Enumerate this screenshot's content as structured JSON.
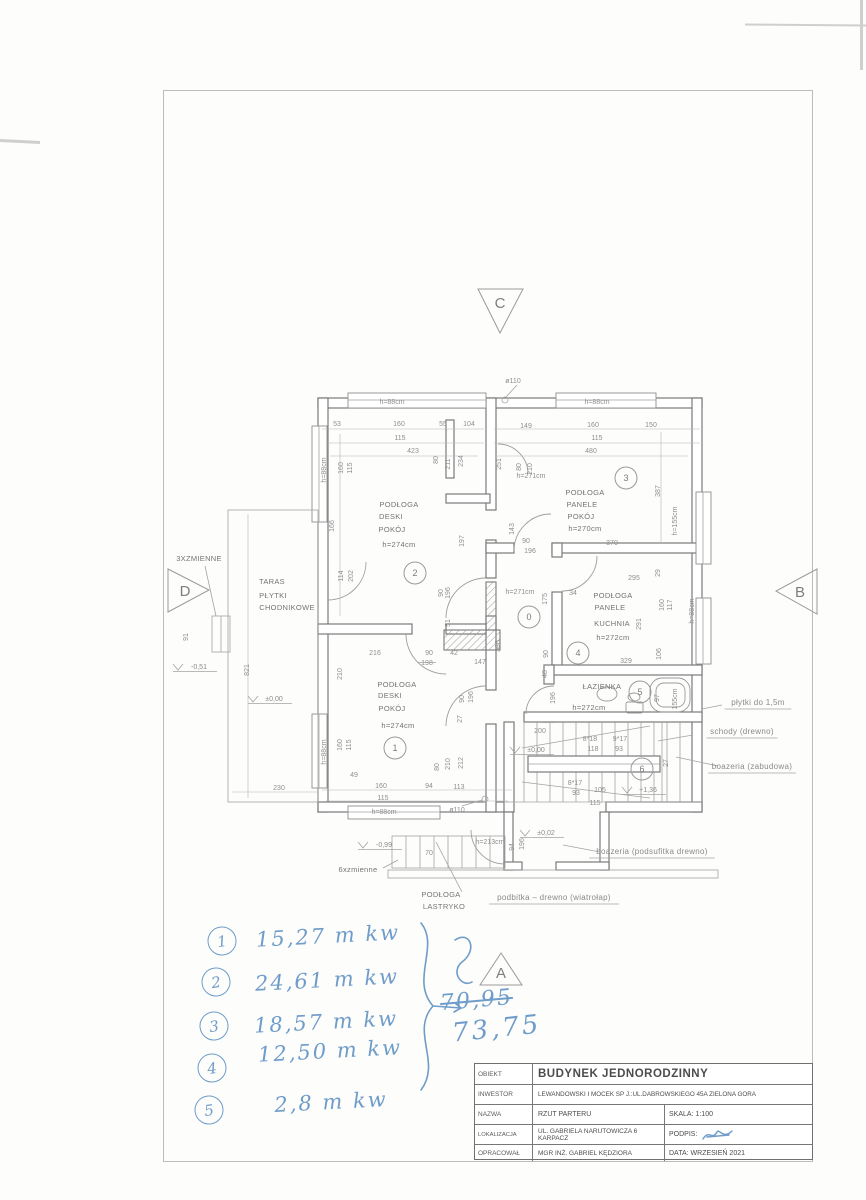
{
  "title_block": {
    "rows": [
      {
        "label": "OBIEKT",
        "value": "BUDYNEK JEDNORODZINNY"
      },
      {
        "label": "INWESTOR",
        "value": "LEWANDOWSKI I MOCEK SP J.:UL.DABROWSKIEGO 45A ZIELONA GORA"
      },
      {
        "label": "NAZWA",
        "value": "RZUT PARTERU",
        "right_label": "SKALA:",
        "right_value": "1:100"
      },
      {
        "label": "LOKALIZACJA",
        "value": "UL. GABRIELA NARUTOWICZA 6 KARPACZ",
        "right_label": "PODPIS:",
        "right_value": ""
      },
      {
        "label": "OPRACOWAŁ",
        "value": "MGR INŻ. GABRIEL KĘDZIORA",
        "right_label": "DATA:",
        "right_value": "WRZESIEŃ 2021"
      }
    ]
  },
  "handwritten": {
    "items": [
      {
        "n": "1",
        "t": "15,27 m kw",
        "cx": 222,
        "cy": 941,
        "tx": 328,
        "ty": 936
      },
      {
        "n": "2",
        "t": "24,61 m kw",
        "cx": 216,
        "cy": 982,
        "tx": 327,
        "ty": 980
      },
      {
        "n": "3",
        "t": "18,57 m kw",
        "cx": 214,
        "cy": 1026,
        "tx": 326,
        "ty": 1022
      },
      {
        "n": "4",
        "t": "12,50 m kw",
        "cx": 212,
        "cy": 1068,
        "tx": 330,
        "ty": 1051
      },
      {
        "n": "5",
        "t": "2,8  m kw",
        "cx": 209,
        "cy": 1110,
        "tx": 331,
        "ty": 1102
      }
    ],
    "sum_old": "70,95",
    "sum_new": "73,75"
  },
  "markers": {
    "a": "A",
    "b": "B",
    "c": "C",
    "d": "D"
  },
  "plan": {
    "rooms": [
      {
        "n": "2",
        "x": 415,
        "y": 573
      },
      {
        "n": "3",
        "x": 626,
        "y": 478
      },
      {
        "n": "0",
        "x": 529,
        "y": 617
      },
      {
        "n": "4",
        "x": 578,
        "y": 653
      },
      {
        "n": "5",
        "x": 640,
        "y": 692
      },
      {
        "n": "6",
        "x": 642,
        "y": 769
      },
      {
        "n": "1",
        "x": 395,
        "y": 748
      }
    ],
    "labels": [
      {
        "t": "ø110",
        "x": 513,
        "y": 383
      },
      {
        "t": "h=88cm",
        "x": 392,
        "y": 404
      },
      {
        "t": "h=88cm",
        "x": 597,
        "y": 404
      },
      {
        "t": "53",
        "x": 337,
        "y": 426
      },
      {
        "t": "160",
        "x": 399,
        "y": 426
      },
      {
        "t": "55",
        "x": 443,
        "y": 426
      },
      {
        "t": "104",
        "x": 469,
        "y": 426
      },
      {
        "t": "115",
        "x": 400,
        "y": 440
      },
      {
        "t": "423",
        "x": 413,
        "y": 453
      },
      {
        "t": "80",
        "x": 438,
        "y": 460,
        "v": 1
      },
      {
        "t": "211",
        "x": 450,
        "y": 464,
        "v": 1
      },
      {
        "t": "234",
        "x": 463,
        "y": 461,
        "v": 1
      },
      {
        "t": "149",
        "x": 526,
        "y": 428
      },
      {
        "t": "160",
        "x": 593,
        "y": 427
      },
      {
        "t": "150",
        "x": 651,
        "y": 427
      },
      {
        "t": "115",
        "x": 597,
        "y": 440
      },
      {
        "t": "480",
        "x": 591,
        "y": 453
      },
      {
        "t": "251",
        "x": 501,
        "y": 464,
        "v": 1
      },
      {
        "t": "80",
        "x": 521,
        "y": 467,
        "v": 1
      },
      {
        "t": "210",
        "x": 532,
        "y": 469,
        "v": 1
      },
      {
        "t": "h=271cm",
        "x": 531,
        "y": 478
      },
      {
        "t": "387",
        "x": 660,
        "y": 491,
        "v": 1
      },
      {
        "t": "h=155cm",
        "x": 677,
        "y": 521,
        "v": 1
      },
      {
        "t": "PODŁOGA",
        "x": 585,
        "y": 495,
        "c": "lbl"
      },
      {
        "t": "PANELE",
        "x": 582,
        "y": 507,
        "c": "lbl"
      },
      {
        "t": "POKÓJ",
        "x": 581,
        "y": 519,
        "c": "lbl"
      },
      {
        "t": "h=270cm",
        "x": 585,
        "y": 531,
        "c": "lbl"
      },
      {
        "t": "143",
        "x": 514,
        "y": 529,
        "v": 1
      },
      {
        "t": "90",
        "x": 526,
        "y": 543
      },
      {
        "t": "196",
        "x": 530,
        "y": 553
      },
      {
        "t": "370",
        "x": 612,
        "y": 545
      },
      {
        "t": "h=88cm",
        "x": 326,
        "y": 470,
        "v": 1
      },
      {
        "t": "160",
        "x": 343,
        "y": 468,
        "v": 1
      },
      {
        "t": "115",
        "x": 352,
        "y": 468,
        "v": 1
      },
      {
        "t": "166",
        "x": 334,
        "y": 526,
        "v": 1
      },
      {
        "t": "197",
        "x": 464,
        "y": 541,
        "v": 1
      },
      {
        "t": "114",
        "x": 343,
        "y": 576,
        "v": 1
      },
      {
        "t": "202",
        "x": 353,
        "y": 576,
        "v": 1
      },
      {
        "t": "PODŁOGA",
        "x": 399,
        "y": 507,
        "c": "lbl"
      },
      {
        "t": "DESKI",
        "x": 391,
        "y": 519,
        "c": "lbl"
      },
      {
        "t": "POKÓJ",
        "x": 392,
        "y": 532,
        "c": "lbl"
      },
      {
        "t": "h=274cm",
        "x": 399,
        "y": 547,
        "c": "lbl"
      },
      {
        "t": "h=271cm",
        "x": 520,
        "y": 594
      },
      {
        "t": "90",
        "x": 443,
        "y": 593,
        "v": 1
      },
      {
        "t": "196",
        "x": 450,
        "y": 593,
        "v": 1
      },
      {
        "t": "51",
        "x": 450,
        "y": 623,
        "v": 1
      },
      {
        "t": "175",
        "x": 547,
        "y": 599,
        "v": 1
      },
      {
        "t": "396",
        "x": 500,
        "y": 646,
        "v": 1
      },
      {
        "t": "147",
        "x": 480,
        "y": 664
      },
      {
        "t": "90",
        "x": 548,
        "y": 654,
        "v": 1
      },
      {
        "t": "48",
        "x": 547,
        "y": 674,
        "v": 1
      },
      {
        "t": "295",
        "x": 634,
        "y": 580
      },
      {
        "t": "29",
        "x": 660,
        "y": 573,
        "v": 1
      },
      {
        "t": "34",
        "x": 573,
        "y": 595
      },
      {
        "t": "PODŁOGA",
        "x": 613,
        "y": 598,
        "c": "lbl"
      },
      {
        "t": "PANELE",
        "x": 610,
        "y": 610,
        "c": "lbl"
      },
      {
        "t": "KUCHNIA",
        "x": 612,
        "y": 626,
        "c": "lbl"
      },
      {
        "t": "h=272cm",
        "x": 613,
        "y": 640,
        "c": "lbl"
      },
      {
        "t": "291",
        "x": 641,
        "y": 624,
        "v": 1
      },
      {
        "t": "160",
        "x": 664,
        "y": 605,
        "v": 1
      },
      {
        "t": "117",
        "x": 672,
        "y": 605,
        "v": 1
      },
      {
        "t": "h=88cm",
        "x": 694,
        "y": 611,
        "v": 1
      },
      {
        "t": "106",
        "x": 661,
        "y": 654,
        "v": 1
      },
      {
        "t": "329",
        "x": 626,
        "y": 663
      },
      {
        "t": "ŁAZIENKA",
        "x": 602,
        "y": 689,
        "c": "lbl"
      },
      {
        "t": "h=272cm",
        "x": 589,
        "y": 710,
        "c": "lbl"
      },
      {
        "t": "97",
        "x": 659,
        "y": 698,
        "v": 1
      },
      {
        "t": "155cm",
        "x": 677,
        "y": 699,
        "v": 1
      },
      {
        "t": "196",
        "x": 555,
        "y": 698,
        "v": 1
      },
      {
        "t": "200",
        "x": 540,
        "y": 733
      },
      {
        "t": "±0,00",
        "x": 536,
        "y": 752,
        "c": "lvl"
      },
      {
        "t": "8*18",
        "x": 590,
        "y": 741
      },
      {
        "t": "9*17",
        "x": 620,
        "y": 741
      },
      {
        "t": "118",
        "x": 593,
        "y": 751
      },
      {
        "t": "93",
        "x": 619,
        "y": 751
      },
      {
        "t": "8*17",
        "x": 575,
        "y": 785
      },
      {
        "t": "93",
        "x": 576,
        "y": 795
      },
      {
        "t": "105",
        "x": 600,
        "y": 792
      },
      {
        "t": "115",
        "x": 595,
        "y": 805
      },
      {
        "t": "+1,36",
        "x": 648,
        "y": 792,
        "c": "lvl"
      },
      {
        "t": "27",
        "x": 668,
        "y": 763,
        "v": 1
      },
      {
        "t": "PODŁOGA",
        "x": 397,
        "y": 687,
        "c": "lbl"
      },
      {
        "t": "DESKI",
        "x": 390,
        "y": 698,
        "c": "lbl"
      },
      {
        "t": "POKÓJ",
        "x": 392,
        "y": 711,
        "c": "lbl"
      },
      {
        "t": "h=274cm",
        "x": 398,
        "y": 728,
        "c": "lbl"
      },
      {
        "t": "216",
        "x": 375,
        "y": 655
      },
      {
        "t": "90",
        "x": 429,
        "y": 655
      },
      {
        "t": "42",
        "x": 454,
        "y": 655
      },
      {
        "t": "198",
        "x": 427,
        "y": 665,
        "c": "strike"
      },
      {
        "t": "210",
        "x": 342,
        "y": 674,
        "v": 1
      },
      {
        "t": "h=88cm",
        "x": 326,
        "y": 752,
        "v": 1
      },
      {
        "t": "160",
        "x": 342,
        "y": 745,
        "v": 1
      },
      {
        "t": "115",
        "x": 351,
        "y": 745,
        "v": 1
      },
      {
        "t": "49",
        "x": 354,
        "y": 777
      },
      {
        "t": "160",
        "x": 381,
        "y": 788
      },
      {
        "t": "94",
        "x": 429,
        "y": 788
      },
      {
        "t": "113",
        "x": 459,
        "y": 789
      },
      {
        "t": "115",
        "x": 383,
        "y": 800
      },
      {
        "t": "h=88cm",
        "x": 384,
        "y": 814
      },
      {
        "t": "ø110",
        "x": 457,
        "y": 812
      },
      {
        "t": "80",
        "x": 439,
        "y": 767,
        "v": 1
      },
      {
        "t": "210",
        "x": 450,
        "y": 764,
        "v": 1
      },
      {
        "t": "212",
        "x": 463,
        "y": 763,
        "v": 1
      },
      {
        "t": "90",
        "x": 464,
        "y": 699,
        "v": 1
      },
      {
        "t": "196",
        "x": 473,
        "y": 697,
        "v": 1
      },
      {
        "t": "27",
        "x": 462,
        "y": 719,
        "v": 1
      },
      {
        "t": "h=213cm",
        "x": 490,
        "y": 844
      },
      {
        "t": "94",
        "x": 514,
        "y": 847,
        "v": 1
      },
      {
        "t": "196",
        "x": 524,
        "y": 844,
        "v": 1
      },
      {
        "t": "±0,02",
        "x": 546,
        "y": 835,
        "c": "lvl"
      },
      {
        "t": "-0,99",
        "x": 384,
        "y": 847,
        "c": "lvl"
      },
      {
        "t": "70",
        "x": 429,
        "y": 855
      },
      {
        "t": "6xzmienne",
        "x": 358,
        "y": 872,
        "c": "lbl"
      },
      {
        "t": "PODŁOGA",
        "x": 441,
        "y": 897,
        "c": "lbl"
      },
      {
        "t": "LASTRYKO",
        "x": 444,
        "y": 909,
        "c": "lbl"
      },
      {
        "t": "3XZMIENNE",
        "x": 199,
        "y": 561,
        "c": "lbl"
      },
      {
        "t": "91",
        "x": 188,
        "y": 637,
        "v": 1
      },
      {
        "t": "-0,51",
        "x": 199,
        "y": 669,
        "c": "lvl"
      },
      {
        "t": "821",
        "x": 249,
        "y": 670,
        "v": 1
      },
      {
        "t": "TARAS",
        "x": 272,
        "y": 584,
        "c": "lbl"
      },
      {
        "t": "PŁYTKI",
        "x": 273,
        "y": 598,
        "c": "lbl"
      },
      {
        "t": "CHODNIKOWE",
        "x": 287,
        "y": 610,
        "c": "lbl"
      },
      {
        "t": "±0,00",
        "x": 274,
        "y": 701,
        "c": "lvl"
      },
      {
        "t": "230",
        "x": 279,
        "y": 790
      },
      {
        "t": "płytki do 1,5m",
        "x": 758,
        "y": 705,
        "c": "note"
      },
      {
        "t": "schody (drewno)",
        "x": 742,
        "y": 734,
        "c": "note"
      },
      {
        "t": "boazeria (zabudowa)",
        "x": 752,
        "y": 769,
        "c": "note"
      },
      {
        "t": "boazeria (podsufitka drewno)",
        "x": 652,
        "y": 854,
        "c": "note"
      },
      {
        "t": "podbitka – drewno (wiatrołap)",
        "x": 554,
        "y": 900,
        "c": "note"
      }
    ]
  }
}
